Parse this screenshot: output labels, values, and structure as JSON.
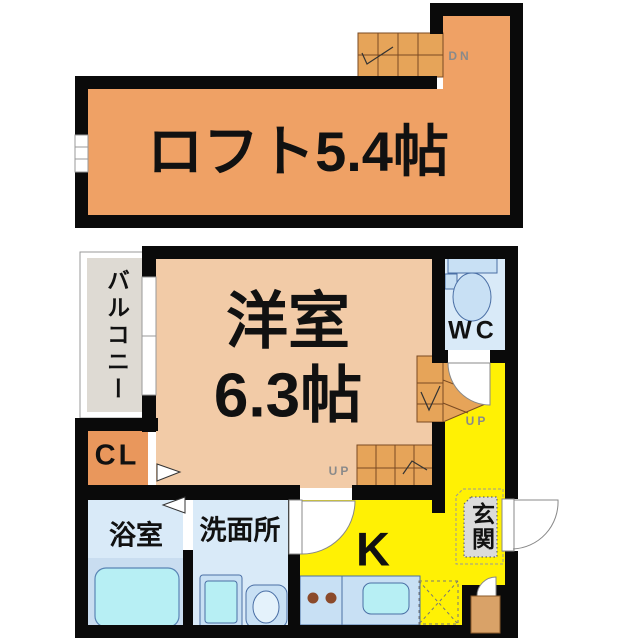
{
  "loft": {
    "label": "ロフト5.4帖",
    "stair_down": "DN"
  },
  "floor": {
    "room": {
      "name": "洋室",
      "size": "6.3帖"
    },
    "balcony": {
      "label": "バルコニー"
    },
    "toilet": {
      "label": "WC"
    },
    "closet": {
      "label": "CL"
    },
    "bath": {
      "label": "浴室"
    },
    "washroom": {
      "label": "洗面所"
    },
    "kitchen": {
      "label": "K"
    },
    "entrance": {
      "label": "玄関"
    },
    "stairs": {
      "up_hall": "UP",
      "up_room": "UP"
    }
  },
  "colors": {
    "wall": "#0a0a0a",
    "loft": "#EFA165",
    "room": "#F2CBA7",
    "closet": "#E9975C",
    "stair": "#E6A459",
    "kitchen": "#FFF104",
    "water_room": "#D9EAF8",
    "bath_band": "#C9DDF0",
    "fixture": "#C8E0F4",
    "fixture_inner": "#B7EFF4",
    "balcony": "#DEDAD3",
    "entrance_pad": "#DBDBDB",
    "cabinet": "#D9A268",
    "label": "#111111",
    "label_gray": "#8a8a8a"
  }
}
